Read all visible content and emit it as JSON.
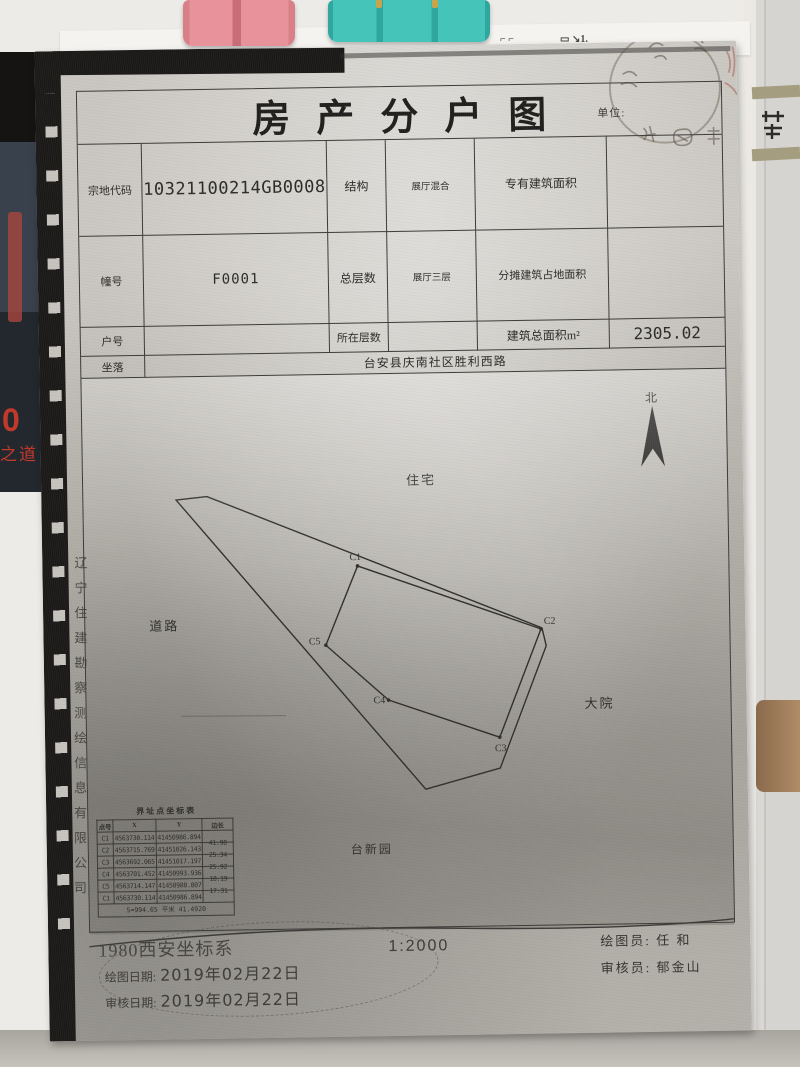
{
  "photo": {
    "poster": {
      "num": "0",
      "text": "之道"
    },
    "colors": {
      "clip_pink": "#e8939b",
      "clip_teal": "#45c4ba",
      "poster_red": "#c0392b"
    }
  },
  "doc": {
    "title": "房产分户图",
    "seal": {
      "unit_label": "单位:"
    },
    "info_table": {
      "parcel_code_label": "宗地代码",
      "parcel_code": "210321100214GB00080",
      "structure_label": "结构",
      "structure": "展厅混合",
      "exclusive_area_label": "专有建筑面积",
      "building_no_label": "幢号",
      "building_no": "F0001",
      "total_floors_label": "总层数",
      "total_floors": "展厅三层",
      "shared_footprint_label": "分摊建筑占地面积",
      "house_no_label": "户号",
      "floor_label": "所在层数",
      "total_area_label": "建筑总面积m²",
      "total_area": "2305.02",
      "location_label": "坐落",
      "location": "台安县庆南社区胜利西路"
    },
    "map": {
      "north": "北",
      "labels": {
        "residential": "住宅",
        "road": "道路",
        "courtyard": "大院",
        "garden": "台新园"
      },
      "points": [
        "C1",
        "C2",
        "C3",
        "C4",
        "C5"
      ],
      "scale": "1:2000"
    },
    "coord": {
      "title": "界址点坐标表",
      "headers": [
        "点号",
        "X",
        "Y",
        "边长"
      ],
      "rows": [
        {
          "p": "C1",
          "x": "4563730.114",
          "y": "41450986.894",
          "len": ""
        },
        {
          "p": "C2",
          "x": "4563715.769",
          "y": "41451026.143",
          "len": "41.98"
        },
        {
          "p": "C3",
          "x": "4563692.065",
          "y": "41451017.197",
          "len": "25.34"
        },
        {
          "p": "C4",
          "x": "4563701.452",
          "y": "41450993.936",
          "len": "25.92"
        },
        {
          "p": "C5",
          "x": "4563714.147",
          "y": "41450980.007",
          "len": "18.19"
        },
        {
          "p": "C1",
          "x": "4563730.114",
          "y": "41450986.894",
          "len": "17.31"
        }
      ],
      "footer": "S=994.65 平米 41.4920"
    },
    "footer": {
      "coord_system": "1980西安坐标系",
      "draw_date_label": "绘图日期:",
      "draw_date": "2019年02月22日",
      "review_date_label": "审核日期:",
      "review_date": "2019年02月22日",
      "drafter_label": "绘图员:",
      "drafter": "任  和",
      "reviewer_label": "审核员:",
      "reviewer": "郁金山"
    },
    "company_vertical": "辽宁住建勘察测绘信息有限公司"
  }
}
